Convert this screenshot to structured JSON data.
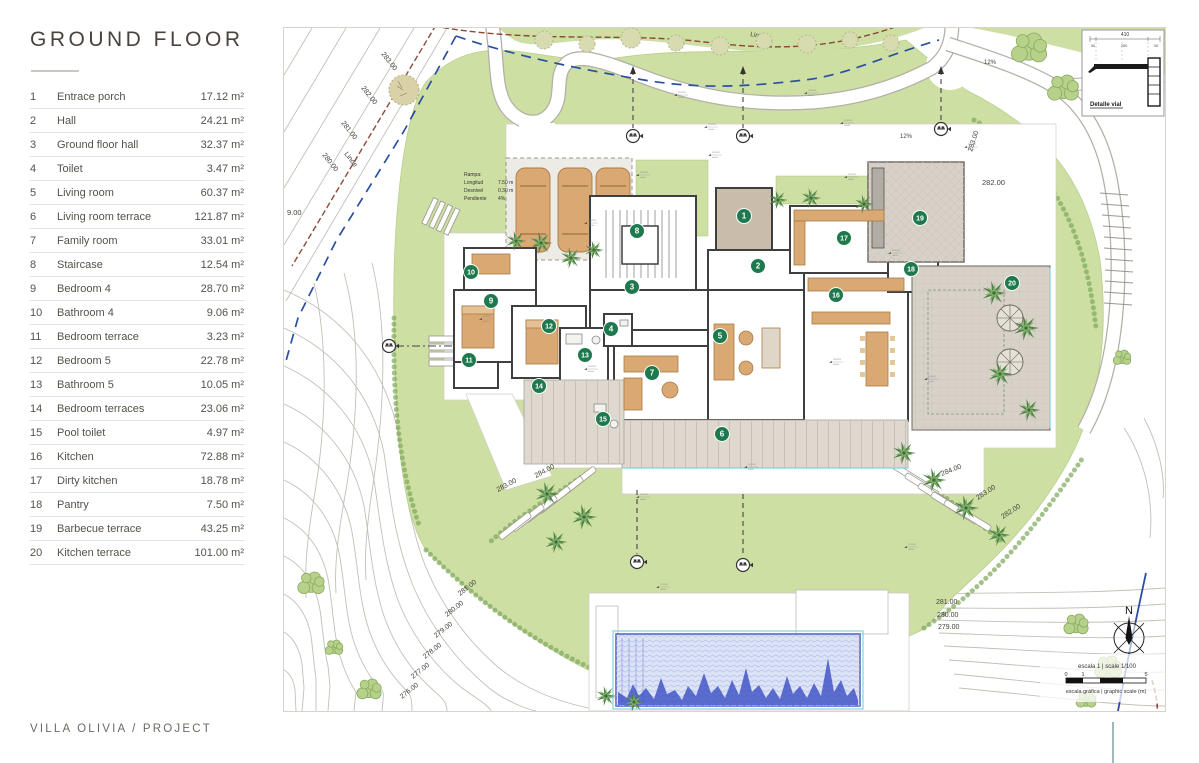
{
  "sidebar": {
    "title": "GROUND FLOOR",
    "rooms": [
      {
        "num": "1",
        "name": "Entrace porch",
        "area": "17.12 m²"
      },
      {
        "num": "2",
        "name": "Hall",
        "area": "24.21 m²"
      },
      {
        "num": "3",
        "name": "Ground floor hall",
        "area": "32.37 m²"
      },
      {
        "num": "4",
        "name": "Toilet",
        "area": "3.47 m²"
      },
      {
        "num": "5",
        "name": "Living room",
        "area": "60.37 m²"
      },
      {
        "num": "6",
        "name": "Living room terrace",
        "area": "121.87 m²"
      },
      {
        "num": "7",
        "name": "Family room",
        "area": "33.01 m²"
      },
      {
        "num": "8",
        "name": "Staircase",
        "area": "12.54 m²"
      },
      {
        "num": "9",
        "name": "Bedroom 4",
        "area": "28.70 m²"
      },
      {
        "num": "10",
        "name": "Bathroom 4",
        "area": "9.06 m²"
      },
      {
        "num": "11",
        "name": "Bedroom terrace",
        "area": "3.23 m²"
      },
      {
        "num": "12",
        "name": "Bedroom 5",
        "area": "22.78 m²"
      },
      {
        "num": "13",
        "name": "Bathroom 5",
        "area": "10.05 m²"
      },
      {
        "num": "14",
        "name": "Bedroom terraces",
        "area": "23.06 m²"
      },
      {
        "num": "15",
        "name": "Pool toilet",
        "area": "4.97 m²"
      },
      {
        "num": "16",
        "name": "Kitchen",
        "area": "72.88 m²"
      },
      {
        "num": "17",
        "name": "Dirty kitchen",
        "area": "18.78 m²"
      },
      {
        "num": "18",
        "name": "Pantry",
        "area": "7.50 m²"
      },
      {
        "num": "19",
        "name": "Barbecue terrace",
        "area": "43.25 m²"
      },
      {
        "num": "20",
        "name": "Kitchen terrace",
        "area": "101.00 m²"
      }
    ]
  },
  "footer": {
    "project": "VILLA OLIVIA  /  PROJECT"
  },
  "plan": {
    "boundary_label": "Linde",
    "boundary_label_2": "Linde",
    "partial_contour": "9.00",
    "contours": {
      "top_left": [
        "283.00",
        "282.00",
        "281.00",
        "280.00"
      ],
      "bottom_left": [
        "281.00",
        "280.00",
        "279.00",
        "278.00",
        "277.00",
        "276.00"
      ],
      "left_mid": [
        "284.00",
        "283.00"
      ],
      "right_steps": [
        "284.00",
        "283.00",
        "282.00"
      ],
      "bottom_right": [
        "281.00",
        "280.00",
        "279.00"
      ],
      "right_mid": "282.00",
      "right_top": "283.00"
    },
    "slope_labels": [
      "12%",
      "12%"
    ],
    "ramp_note": {
      "title": "Rampa:",
      "lines": [
        [
          "Longitud",
          "7.50 m"
        ],
        [
          "Desnivel",
          "0.30 m"
        ],
        [
          "Pendiente",
          "4%"
        ]
      ]
    },
    "road_detail": {
      "title": "Detalle vial",
      "dim_total": "410",
      "dims": [
        "30",
        "350",
        "30"
      ]
    },
    "compass": {
      "north": "N"
    },
    "scale_bar": {
      "label": "escala 1 | scale 1/100",
      "ticks": [
        "0",
        "1",
        "5"
      ],
      "caption": "escala gráfica | graphic scale (m)"
    }
  },
  "colors": {
    "marker": "#1e7a4e",
    "lawn": "#cddfa3",
    "pool_line": "#4c5fc0",
    "pool_fill": "#dde3f7",
    "boundary": "#8a4a35",
    "utility": "#2b4fa0",
    "wall": "#3f3f3f",
    "furniture": "#d9a873"
  }
}
